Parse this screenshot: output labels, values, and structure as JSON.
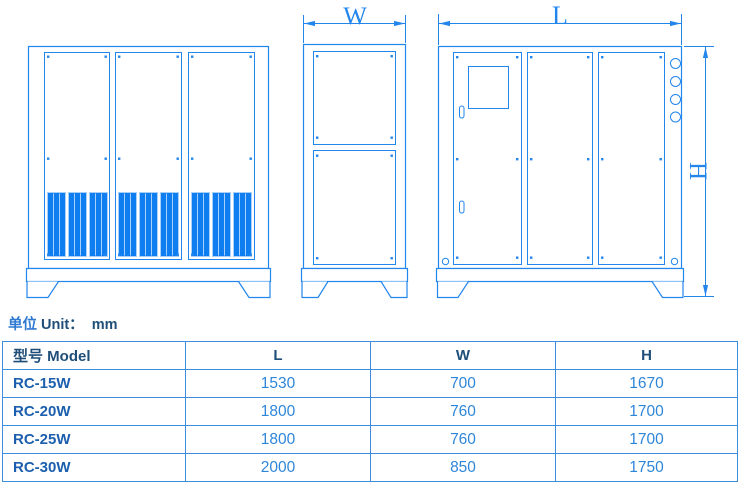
{
  "drawing": {
    "dim_labels": {
      "width": "W",
      "length": "L",
      "height": "H"
    }
  },
  "unit_note": {
    "cn": "单位",
    "en": "Unit：",
    "value": "mm"
  },
  "table": {
    "headers": [
      "型号 Model",
      "L",
      "W",
      "H"
    ],
    "rows": [
      [
        "RC-15W",
        "1530",
        "700",
        "1670"
      ],
      [
        "RC-20W",
        "1800",
        "760",
        "1700"
      ],
      [
        "RC-25W",
        "1800",
        "760",
        "1700"
      ],
      [
        "RC-30W",
        "2000",
        "850",
        "1750"
      ]
    ]
  },
  "colors": {
    "line_blue": "#2286ED",
    "vent_fill": "#0E7EF0",
    "vent_divider": "#A9D0FA",
    "table_border": "#3E8EE0",
    "header_text": "#1F4E79",
    "model_text": "#1B5FAE",
    "value_text": "#2E86D9"
  }
}
